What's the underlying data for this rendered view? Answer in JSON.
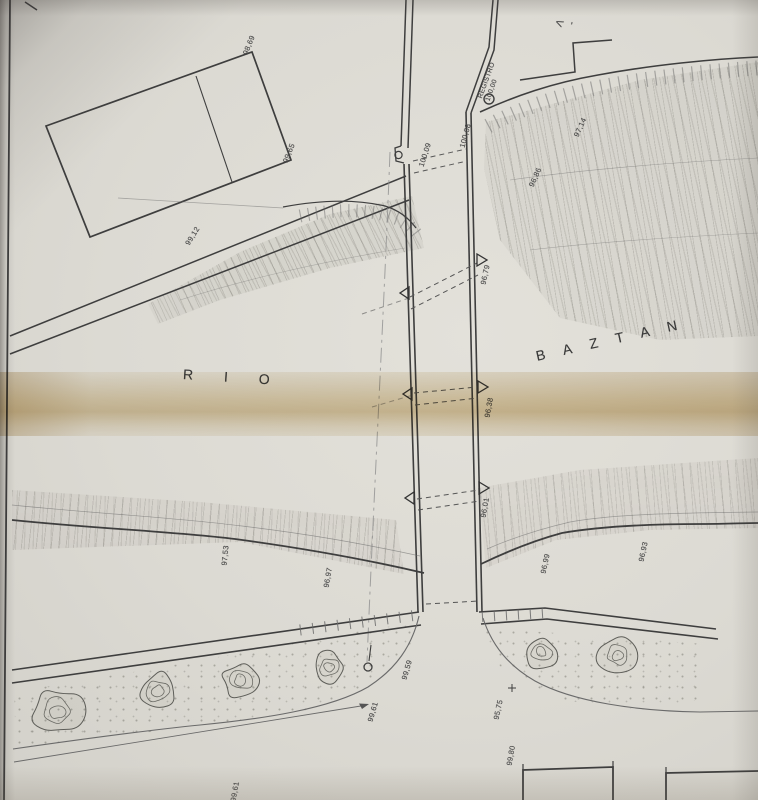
{
  "plan": {
    "river_name_left": "RIO",
    "river_name_right": "BAZTAN",
    "registro": {
      "label": "REGISTRO",
      "elevation": "100,00"
    },
    "top_edge_fragment": "V",
    "top_edge_fragment_dash": "-",
    "elevations": {
      "building_top": "98,69",
      "building_right": "99,65",
      "road_upper": "99,12",
      "channel_top_left": "100,09",
      "channel_top_right": "100,08",
      "wall_upper": "96,79",
      "wall_middle": "96,38",
      "wall_lower": "96,01",
      "bank_upper_right_a": "96,86",
      "bank_upper_right_b": "97,14",
      "bank_lower_left": "97,53",
      "bank_lower_mid": "96,97",
      "bank_lower_right_a": "96,99",
      "bank_lower_right_b": "96,93",
      "road_bottom_a": "99,59",
      "road_bottom_b": "99,61",
      "road_bottom_c": "99,61",
      "spot_point": "95,75",
      "building_bottom": "99,80"
    }
  }
}
